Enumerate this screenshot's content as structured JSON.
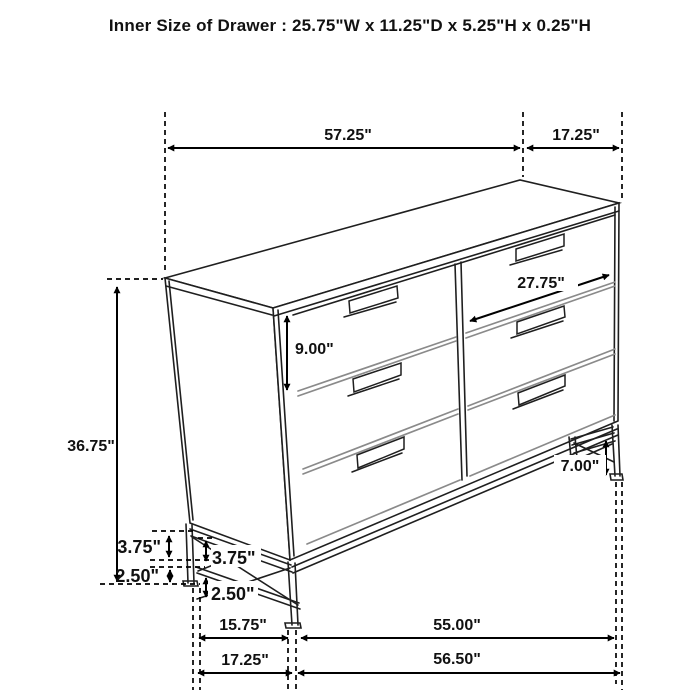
{
  "title": "Inner Size of Drawer : 25.75\"W x 11.25\"D x 5.25\"H x 0.25\"H",
  "diagram": {
    "type": "furniture-dimension-drawing",
    "item": "6-drawer dresser",
    "line_color": "#1f1f1f",
    "separator_color": "#8a8a8a",
    "dimension_color": "#000000",
    "background": "#ffffff"
  },
  "dimensions": {
    "overall_width": "57.25\"",
    "overall_depth": "17.25\"",
    "drawer_front_width": "27.75\"",
    "drawer_front_height": "9.00\"",
    "overall_height": "36.75\"",
    "right_leg_height": "7.00\"",
    "side_rail_gap_outer": "3.75\"",
    "side_rail_gap_inner": "3.75\"",
    "foot_height_outer": "2.50\"",
    "foot_height_inner": "2.50\"",
    "side_leg_spacing": "15.75\"",
    "front_leg_spacing": "55.00\"",
    "base_depth": "17.25\"",
    "base_width": "56.50\""
  }
}
